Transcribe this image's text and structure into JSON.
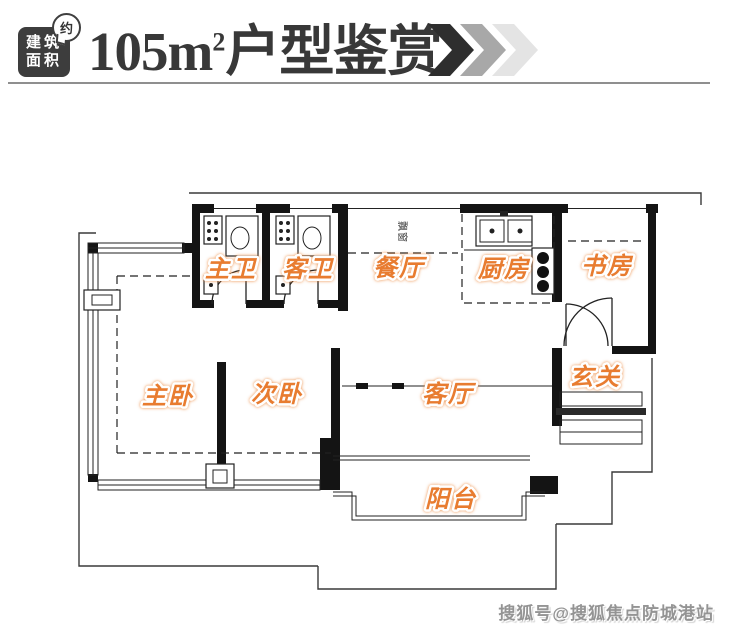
{
  "header": {
    "badge": {
      "line1": "建筑",
      "line2": "面积",
      "bubble": "约"
    },
    "title": {
      "number": "105",
      "unit": "m",
      "superscript": "2",
      "suffix": "户型鉴赏"
    },
    "colors": {
      "badge_bg": "#3d3d3d",
      "title_text": "#383838",
      "chevron1": "#2e2e2e",
      "chevron2": "#a8a8a8",
      "chevron3": "#e4e4e4"
    }
  },
  "floorplan": {
    "label_color": "#e87c30",
    "wall_color": "#141414",
    "bay_window_label": "飘窗",
    "rooms": [
      {
        "id": "master-bath",
        "label": "主卫"
      },
      {
        "id": "guest-bath",
        "label": "客卫"
      },
      {
        "id": "dining-room",
        "label": "餐厅"
      },
      {
        "id": "kitchen",
        "label": "厨房"
      },
      {
        "id": "study",
        "label": "书房"
      },
      {
        "id": "master-bedroom",
        "label": "主卧"
      },
      {
        "id": "second-bedroom",
        "label": "次卧"
      },
      {
        "id": "living-room",
        "label": "客厅"
      },
      {
        "id": "foyer",
        "label": "玄关"
      },
      {
        "id": "balcony",
        "label": "阳台"
      }
    ]
  },
  "footer": {
    "watermark": "搜狐号@搜狐焦点防城港站"
  }
}
